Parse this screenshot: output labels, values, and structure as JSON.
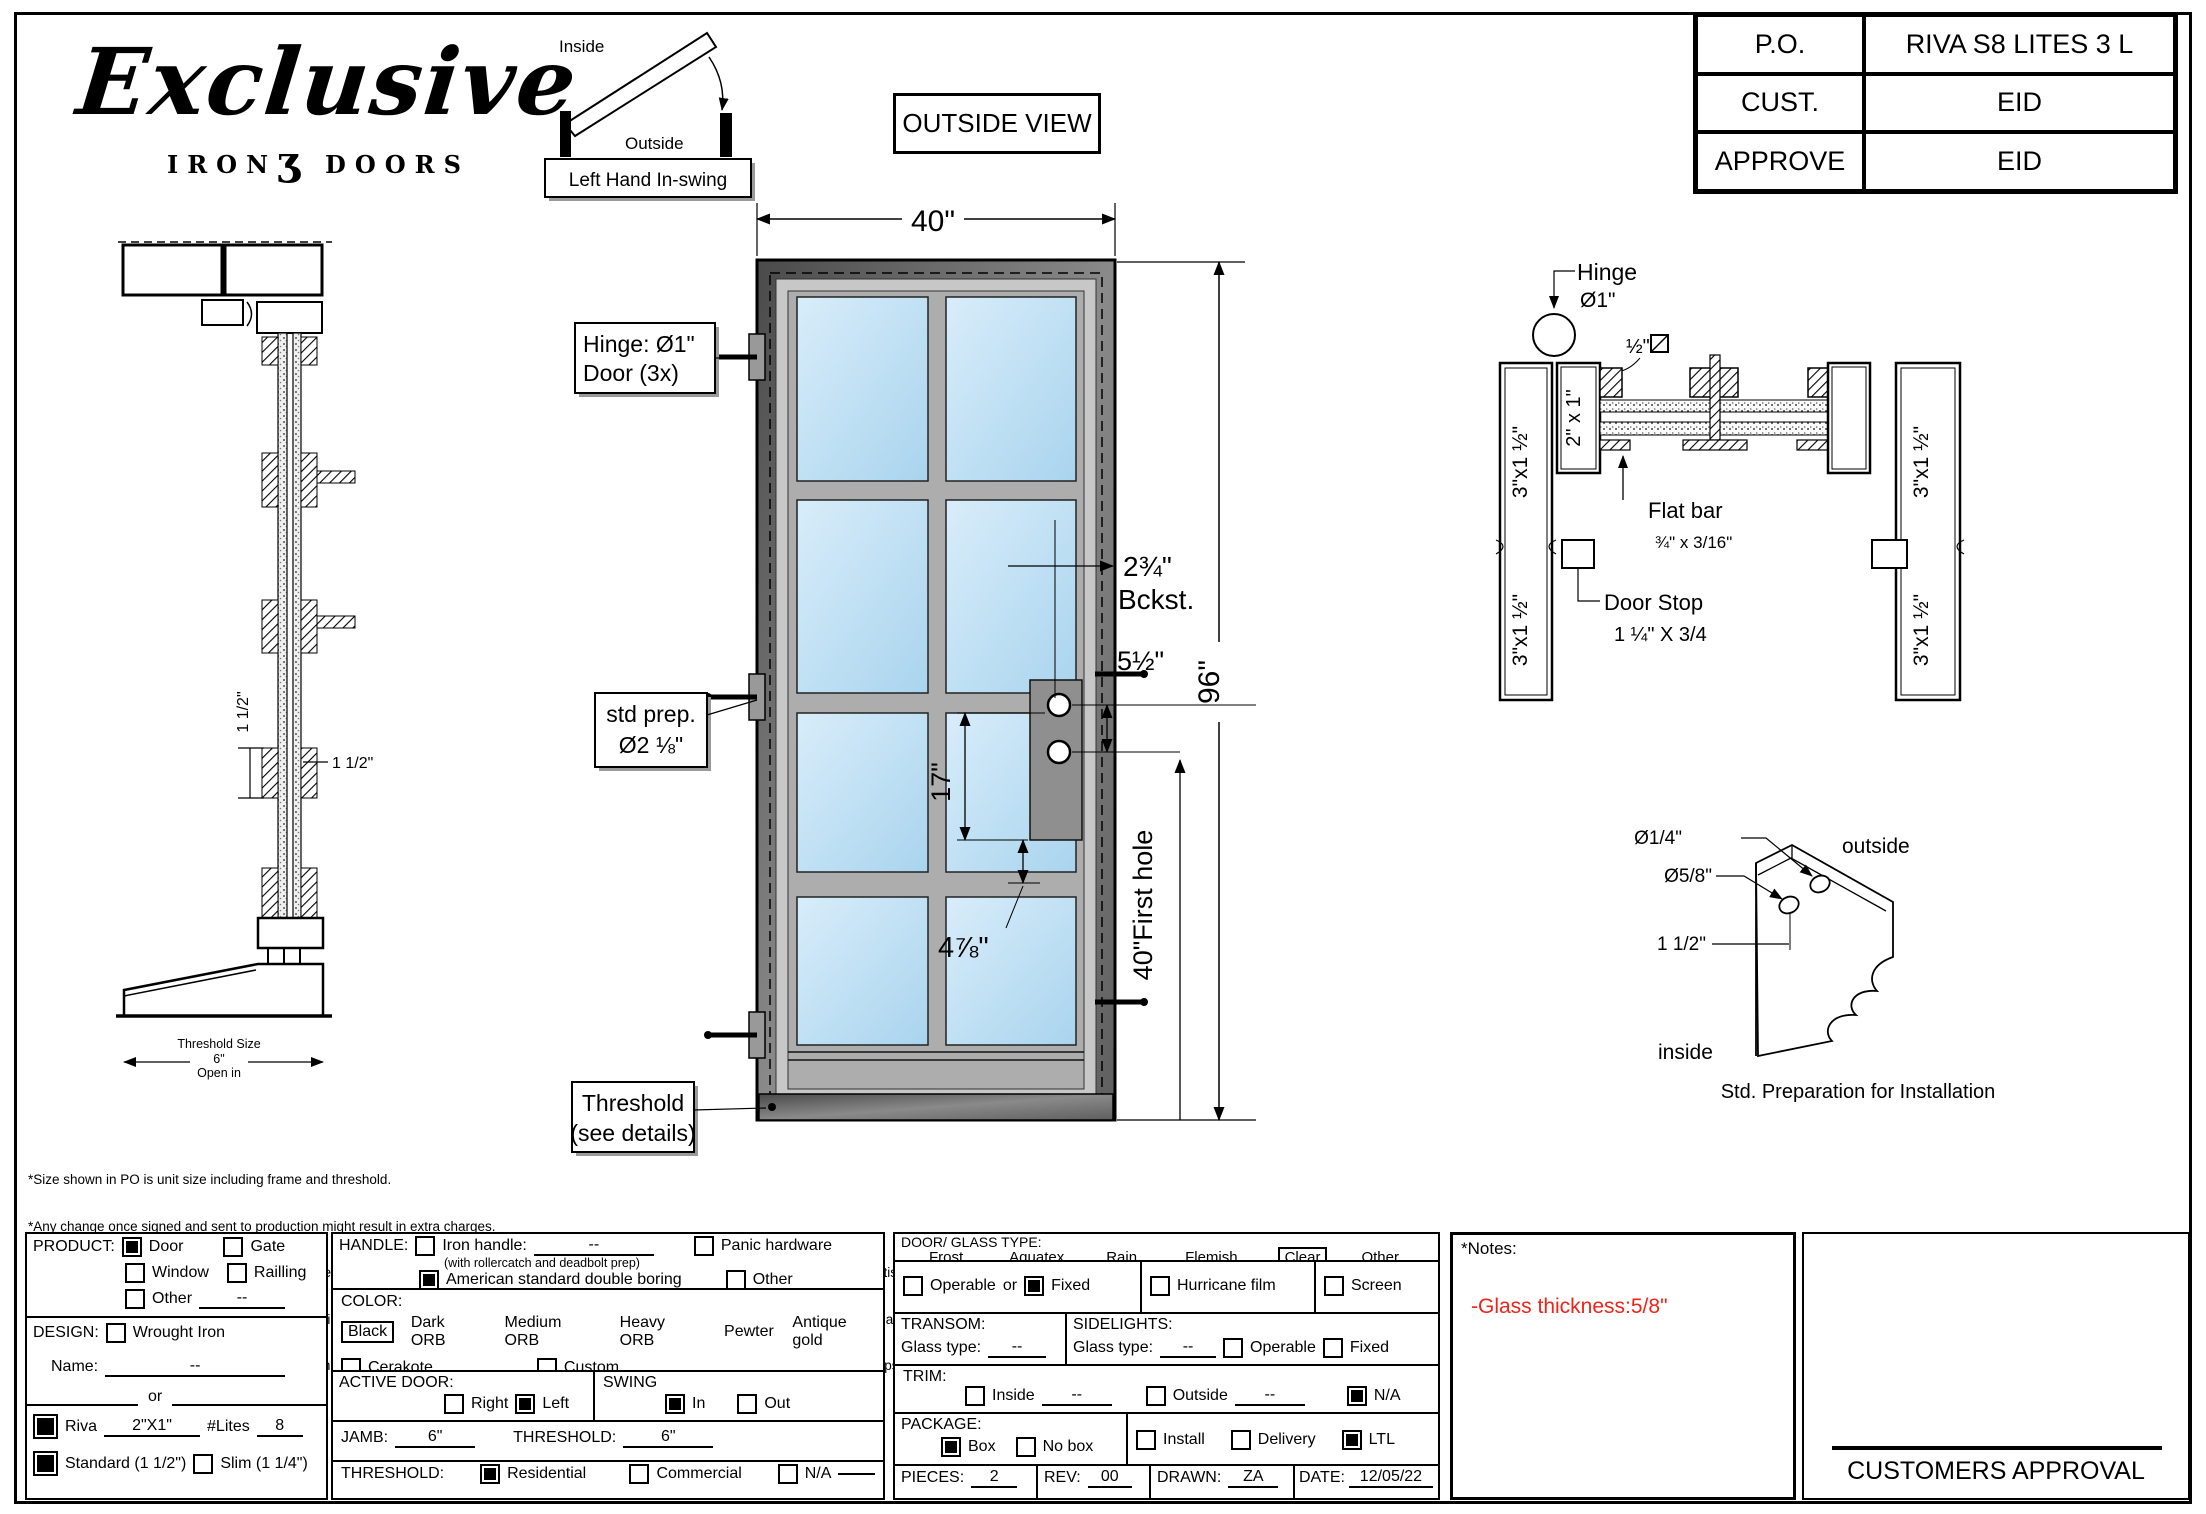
{
  "colors": {
    "glass_light": "#d8edfa",
    "glass_dark": "#a9d4ee",
    "frame_dark": "#4a4a4a",
    "frame_light": "#9a9a9a",
    "accent_red": "#ee2419"
  },
  "logo": {
    "script": "Exclusive",
    "iron": "IRON",
    "glyph": "ʒ",
    "doors": "DOORS"
  },
  "swing": {
    "inside": "Inside",
    "outside": "Outside",
    "caption": "Left Hand In-swing"
  },
  "view_label": "OUTSIDE VIEW",
  "title_block": {
    "rows": [
      {
        "label": "P.O.",
        "value": "RIVA S8 LITES 3 L"
      },
      {
        "label": "CUST.",
        "value": "EID"
      },
      {
        "label": "APPROVE",
        "value": "EID"
      }
    ]
  },
  "door_view": {
    "width": "40\"",
    "height": "96\"",
    "hinge_line1": "Hinge: Ø1\"",
    "hinge_line2": "Door (3x)",
    "backset": "2¾\"",
    "backset_label": "Bckst.",
    "hole_spacing": "5½\"",
    "lock_height": "17\"",
    "hole_offset": "4⅞\"",
    "first_hole": "40\"First hole",
    "prep_line1": "std prep.",
    "prep_line2": "Ø2 ⅛\"",
    "threshold_line1": "Threshold",
    "threshold_line2": "(see details)"
  },
  "side_view": {
    "dim_vertical": "1 1/2\"",
    "dim_horizontal": "1 1/2\"",
    "threshold_line1": "Threshold Size",
    "threshold_line2": "6\"",
    "threshold_line3": "Open in"
  },
  "section_view": {
    "hinge_line1": "Hinge",
    "hinge_line2": "Ø1\"",
    "bar_half": "½\"",
    "tube_vert": "2\" x 1\"",
    "jamb": "3\"x1 ½\"",
    "flat_bar_line1": "Flat bar",
    "flat_bar_line2": "¾\" x 3/16\"",
    "door_stop_line1": "Door Stop",
    "door_stop_line2": "1 ¼\" X 3/4"
  },
  "install_detail": {
    "d1": "Ø1/4\"",
    "d2": "Ø5/8\"",
    "d3": "1 1/2\"",
    "outside": "outside",
    "inside": "inside",
    "caption": "Std. Preparation for Installation"
  },
  "disclaimer": {
    "lines": [
      "*Size shown in PO is unit size including frame and threshold.",
      "*Any change once signed and sent to production might result in extra charges.",
      "Exclusive Iron Doors stands behind the quality of everything we sell and hope you are pleased with your product, if for any reason you are unsatis  ed you can write to one of our",
      "representatives to verify your situation and determine how can we help you, but we do not accept returns in any of our products.Products are   nal and are not eligible for returns, changes",
      "or alterations.By signing you agree to our terms and conditions, delivery pdf and forms of payment. *Doors measurements do not include the gaps between jambs"
    ]
  },
  "form": {
    "product": {
      "label": "PRODUCT:",
      "door": "Door",
      "gate": "Gate",
      "window": "Window",
      "railing": "Railling",
      "other": "Other",
      "other_value": "--",
      "checks": {
        "door": true,
        "gate": false,
        "window": false,
        "railing": false,
        "other": false
      }
    },
    "design": {
      "label": "DESIGN:",
      "wrought": "Wrought Iron",
      "wrought_checked": false,
      "name_label": "Name:",
      "name_value": "--",
      "or": "or"
    },
    "riva": {
      "label": "Riva",
      "value": "2\"X1\"",
      "lites_label": "#Lites",
      "lites_value": "8",
      "checked": true
    },
    "profile": {
      "standard": "Standard (1 1/2\")",
      "slim": "Slim (1 1/4\")",
      "standard_checked": true,
      "slim_checked": false
    },
    "handle": {
      "label": "HANDLE:",
      "iron": "Iron handle:",
      "iron_value": "--",
      "iron_note": "(with rollercatch and deadbolt prep)",
      "asdb": "American standard double boring",
      "panic": "Panic hardware",
      "other": "Other",
      "checks": {
        "iron": false,
        "asdb": true,
        "panic": false,
        "other": false
      }
    },
    "color": {
      "label": "COLOR:",
      "selected": "Black",
      "options": [
        "Dark ORB",
        "Medium ORB",
        "Heavy ORB",
        "Pewter",
        "Antique gold"
      ],
      "cerakote": "Cerakote",
      "custom": "Custom",
      "cerakote_checked": false,
      "custom_checked": false
    },
    "active": {
      "label": "ACTIVE DOOR:",
      "right": "Right",
      "left": "Left",
      "right_checked": false,
      "left_checked": true
    },
    "swing": {
      "label": "SWING",
      "in": "In",
      "out": "Out",
      "in_checked": true,
      "out_checked": false
    },
    "jamb": {
      "label": "JAMB:",
      "value": "6\"",
      "threshold_label": "THRESHOLD:",
      "threshold_value": "6\""
    },
    "threshold": {
      "label": "THRESHOLD:",
      "residential": "Residential",
      "commercial": "Commercial",
      "na": "N/A",
      "residential_checked": true,
      "commercial_checked": false,
      "na_checked": false
    },
    "glass": {
      "label": "DOOR/ GLASS TYPE:",
      "options": [
        "Frost",
        "Aquatex",
        "Rain",
        "Flemish"
      ],
      "selected": "Clear",
      "other": "Other"
    },
    "operable": {
      "operable": "Operable",
      "or": "or",
      "fixed": "Fixed",
      "operable_checked": false,
      "fixed_checked": true,
      "hurricane": "Hurricane film",
      "hurricane_checked": false,
      "screen": "Screen",
      "screen_checked": false
    },
    "transom": {
      "label": "TRANSOM:",
      "glass_label": "Glass type:",
      "value": "--"
    },
    "sidelights": {
      "label": "SIDELIGHTS:",
      "glass_label": "Glass type:",
      "value": "--",
      "operable": "Operable",
      "fixed": "Fixed",
      "operable_checked": false,
      "fixed_checked": false
    },
    "trim": {
      "label": "TRIM:",
      "inside": "Inside",
      "inside_value": "--",
      "outside": "Outside",
      "outside_value": "--",
      "na": "N/A",
      "inside_checked": false,
      "outside_checked": false,
      "na_checked": true
    },
    "package": {
      "label": "PACKAGE:",
      "box": "Box",
      "no_box": "No box",
      "box_checked": true,
      "no_box_checked": false,
      "install": "Install",
      "delivery": "Delivery",
      "ltl": "LTL",
      "install_checked": false,
      "delivery_checked": false,
      "ltl_checked": true
    },
    "meta": {
      "pieces_label": "PIECES:",
      "pieces": "2",
      "rev_label": "REV:",
      "rev": "00",
      "drawn_label": "DRAWN:",
      "drawn": "ZA",
      "date_label": "DATE:",
      "date": "12/05/22"
    }
  },
  "notes": {
    "label": "*Notes:",
    "value": "-Glass thickness:5/8\""
  },
  "approval": {
    "label": "CUSTOMERS APPROVAL"
  }
}
